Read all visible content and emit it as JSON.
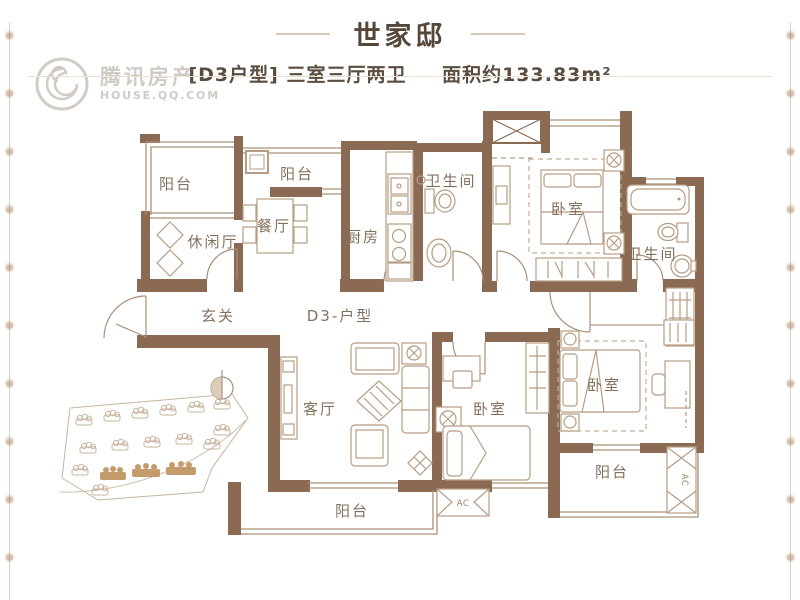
{
  "header": {
    "title": "世家邸",
    "unit_tag": "[D3户型]",
    "layout_desc": "三室三厅两卫",
    "area_desc": "面积约133.83m²"
  },
  "watermark": {
    "brand": "腾讯房产",
    "domain": "HOUSE.QQ.COM"
  },
  "floorplan": {
    "unit_label": "D3-户型",
    "ac_label": "AC",
    "rooms": [
      {
        "id": "balcony-top-left",
        "label": "阳台"
      },
      {
        "id": "balcony-top",
        "label": "阳台"
      },
      {
        "id": "leisure-hall",
        "label": "休闲厅"
      },
      {
        "id": "dining-room",
        "label": "餐厅"
      },
      {
        "id": "kitchen",
        "label": "厨房"
      },
      {
        "id": "bathroom-1",
        "label": "卫生间"
      },
      {
        "id": "bedroom-master",
        "label": "卧室"
      },
      {
        "id": "bathroom-2",
        "label": "卫生间"
      },
      {
        "id": "entry",
        "label": "玄关"
      },
      {
        "id": "living-room",
        "label": "客厅"
      },
      {
        "id": "bedroom-2",
        "label": "卧室"
      },
      {
        "id": "bedroom-3",
        "label": "卧室"
      },
      {
        "id": "balcony-bottom",
        "label": "阳台"
      },
      {
        "id": "balcony-right",
        "label": "阳台"
      }
    ],
    "colors": {
      "wall": "#8a6a52",
      "structure_line": "#ab9078",
      "furniture_line": "#b79c83",
      "label_text": "#84715d"
    }
  }
}
